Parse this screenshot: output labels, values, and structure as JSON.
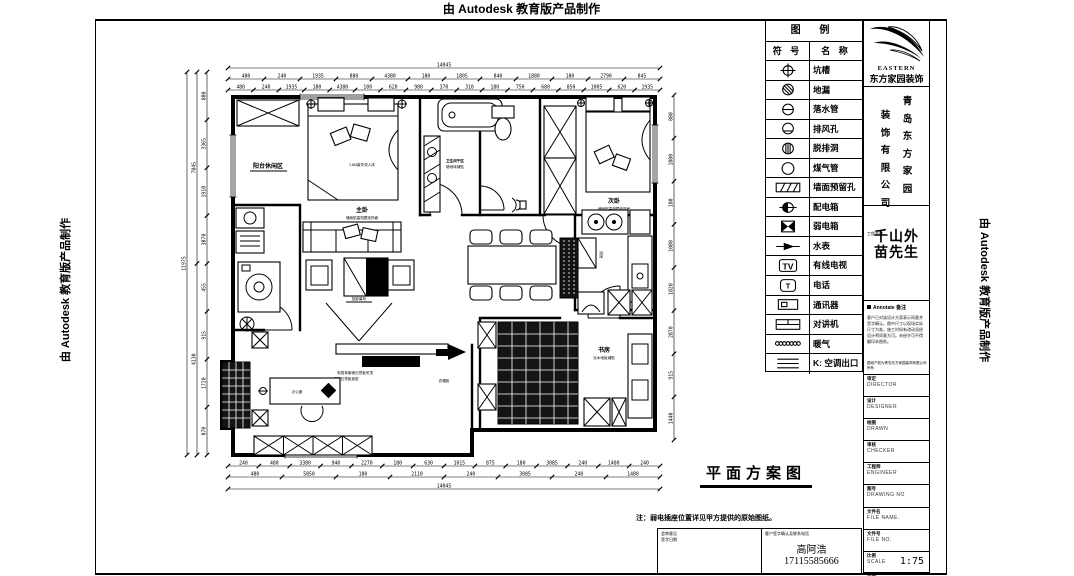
{
  "stamp": {
    "text": "由 Autodesk 教育版产品制作"
  },
  "legend": {
    "title": "图 例",
    "col_symbol": "符 号",
    "col_name": "名 称",
    "items": [
      {
        "name": "坑槽"
      },
      {
        "name": "地漏"
      },
      {
        "name": "落水管"
      },
      {
        "name": "排风孔"
      },
      {
        "name": "脱排洞"
      },
      {
        "name": "煤气管"
      },
      {
        "name": "墙面预留孔"
      },
      {
        "name": "配电箱"
      },
      {
        "name": "弱电箱"
      },
      {
        "name": "水表"
      },
      {
        "name": "有线电视"
      },
      {
        "name": "电话"
      },
      {
        "name": "通讯器"
      },
      {
        "name": "对讲机"
      },
      {
        "name": "暖气"
      },
      {
        "name": "K: 空调出口"
      }
    ]
  },
  "brand": {
    "logo_en": "EASTERN",
    "logo_cn": "东方家园装饰",
    "company_col_left": "装饰有限公司",
    "company_col_right": "青岛东方家园"
  },
  "project": {
    "label": "工程名称",
    "name_line1": "千山外",
    "name_line2": "苗先生"
  },
  "annotate": {
    "header_en": "Annotate",
    "header_cn": "备注",
    "notes": "客户已对该设计方案表示同意并签字确认。图中尺寸以现场实际尺寸为准。施工时如有改动须经设计师同意方可。未经许可不得翻印本图纸。",
    "footer": "图纸产权为青岛东方家园装饰有限公司所有"
  },
  "titleblock": {
    "rows": [
      {
        "cn": "审定",
        "en": "DIRECTOR"
      },
      {
        "cn": "设计",
        "en": "DESIGNER"
      },
      {
        "cn": "绘图",
        "en": "DRAWN"
      },
      {
        "cn": "审核",
        "en": "CHECKER"
      },
      {
        "cn": "工程师",
        "en": "ENGINEER"
      },
      {
        "cn": "图号",
        "en": "DRAWING NO"
      },
      {
        "cn": "文件名",
        "en": "FILE NAME."
      },
      {
        "cn": "文件号",
        "en": "FILE NO."
      },
      {
        "cn": "比例",
        "en": "SCALE"
      },
      {
        "cn": "日期",
        "en": "DATE"
      }
    ],
    "scale_value": "1:75"
  },
  "plan": {
    "title": "平面方案图",
    "note": "注：弱电插座位置详见甲方提供的原始图纸。",
    "contact": {
      "left_header1": "会审意见",
      "left_header2": "签字日期",
      "right_header": "客户签字确认及联系电话",
      "name": "高阿浩",
      "phone": "17115585666"
    },
    "rooms": {
      "balcony_leisure": "阳台休闲区",
      "master": "主卧",
      "master_note": "墙面贴高档壁纸饰面",
      "master_bed": "1.8M豪华双人床",
      "bath": "卫生间干区",
      "bath_note": "墙地砖铺贴",
      "bed2": "次卧",
      "bed2_note": "墙面贴高档壁纸饰面",
      "kitchen": "厨房",
      "study": "书房",
      "study_note": "实木地板铺贴",
      "projector": "投影幕布",
      "tv": "电视背景墙",
      "tv_note": "纸面石膏板造型",
      "office_desk": "办公桌",
      "office_note1": "石膏板吊顶",
      "office_note2": "衣帽柜"
    },
    "dims": {
      "top_overall": [
        "14045"
      ],
      "top_a": [
        "480",
        "240",
        "1935",
        "880",
        "4380",
        "180",
        "1805",
        "840",
        "1880",
        "180",
        "2790",
        "845"
      ],
      "top_b": [
        "480",
        "240",
        "1935",
        "180",
        "4380",
        "180",
        "620",
        "980",
        "370",
        "310",
        "180",
        "750",
        "680",
        "850",
        "1005",
        "620",
        "1935"
      ],
      "bottom_a": [
        "240",
        "480",
        "3380",
        "940",
        "2270",
        "180",
        "630",
        "1015",
        "875",
        "180",
        "3085",
        "240",
        "1480",
        "240"
      ],
      "bottom_b": [
        "480",
        "5850",
        "180",
        "2110",
        "240",
        "3085",
        "240",
        "1480"
      ],
      "bottom_overall": [
        "14045"
      ],
      "left_a": [
        "880",
        "3365",
        "1910",
        "3870",
        "455",
        "915",
        "1720",
        "870"
      ],
      "left_mid": [
        "7845",
        "4130"
      ],
      "left_overall": [
        "11975"
      ],
      "right_a": [
        "880",
        "1880",
        "180",
        "1080",
        "1020",
        "2870",
        "915",
        "1440"
      ]
    }
  }
}
